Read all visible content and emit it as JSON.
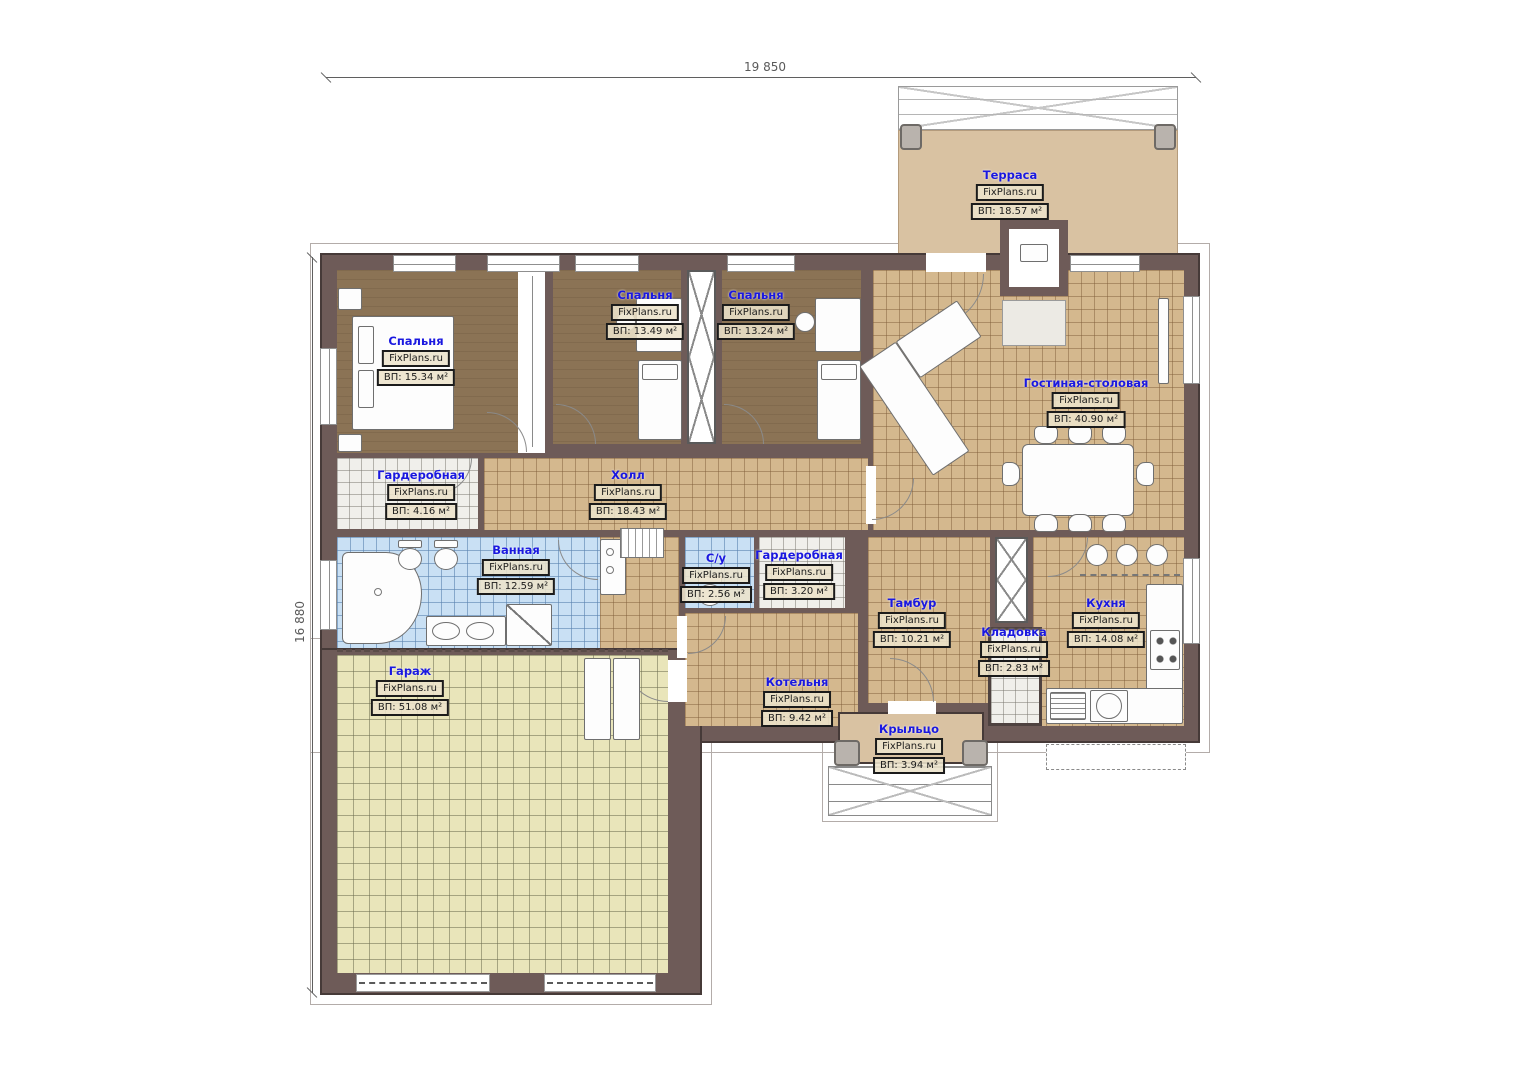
{
  "plan": {
    "dimensions": {
      "width_label": "19 850",
      "height_label": "16 880"
    },
    "watermark": "FixPlans.ru",
    "rooms": [
      {
        "id": "terrace",
        "name": "Терраса",
        "watermark": "FixPlans.ru",
        "area": "ВП: 18.57 м²"
      },
      {
        "id": "bedroom-1",
        "name": "Спальня",
        "watermark": "FixPlans.ru",
        "area": "ВП: 15.34 м²"
      },
      {
        "id": "bedroom-2",
        "name": "Спальня",
        "watermark": "FixPlans.ru",
        "area": "ВП: 13.49 м²"
      },
      {
        "id": "bedroom-3",
        "name": "Спальня",
        "watermark": "FixPlans.ru",
        "area": "ВП: 13.24 м²"
      },
      {
        "id": "living-dining",
        "name": "Гостиная-столовая",
        "watermark": "FixPlans.ru",
        "area": "ВП: 40.90 м²"
      },
      {
        "id": "wardrobe-1",
        "name": "Гардеробная",
        "watermark": "FixPlans.ru",
        "area": "ВП: 4.16 м²"
      },
      {
        "id": "hall",
        "name": "Холл",
        "watermark": "FixPlans.ru",
        "area": "ВП: 18.43 м²"
      },
      {
        "id": "bathroom",
        "name": "Ванная",
        "watermark": "FixPlans.ru",
        "area": "ВП: 12.59 м²"
      },
      {
        "id": "wc",
        "name": "С/у",
        "watermark": "FixPlans.ru",
        "area": "ВП: 2.56 м²"
      },
      {
        "id": "wardrobe-2",
        "name": "Гардеробная",
        "watermark": "FixPlans.ru",
        "area": "ВП: 3.20 м²"
      },
      {
        "id": "vestibule",
        "name": "Тамбур",
        "watermark": "FixPlans.ru",
        "area": "ВП: 10.21 м²"
      },
      {
        "id": "pantry",
        "name": "Кладовка",
        "watermark": "FixPlans.ru",
        "area": "ВП: 2.83 м²"
      },
      {
        "id": "kitchen",
        "name": "Кухня",
        "watermark": "FixPlans.ru",
        "area": "ВП: 14.08 м²"
      },
      {
        "id": "boiler-room",
        "name": "Котельня",
        "watermark": "FixPlans.ru",
        "area": "ВП: 9.42 м²"
      },
      {
        "id": "garage",
        "name": "Гараж",
        "watermark": "FixPlans.ru",
        "area": "ВП: 51.08 м²"
      },
      {
        "id": "porch",
        "name": "Крыльцо",
        "watermark": "FixPlans.ru",
        "area": "ВП: 3.94 м²"
      }
    ],
    "colors": {
      "room_name_text": "#1a18e0",
      "wall": "#6e5b58",
      "tile_beige": "#d4b88e",
      "tile_blue": "#c9e0f4",
      "tile_grey": "#f0efeb",
      "floor_bedroom": "#8b7355",
      "floor_garage": "#e9e5ba",
      "terrace_floor": "#d9c2a2",
      "label_border": "#1b1b1b"
    }
  }
}
